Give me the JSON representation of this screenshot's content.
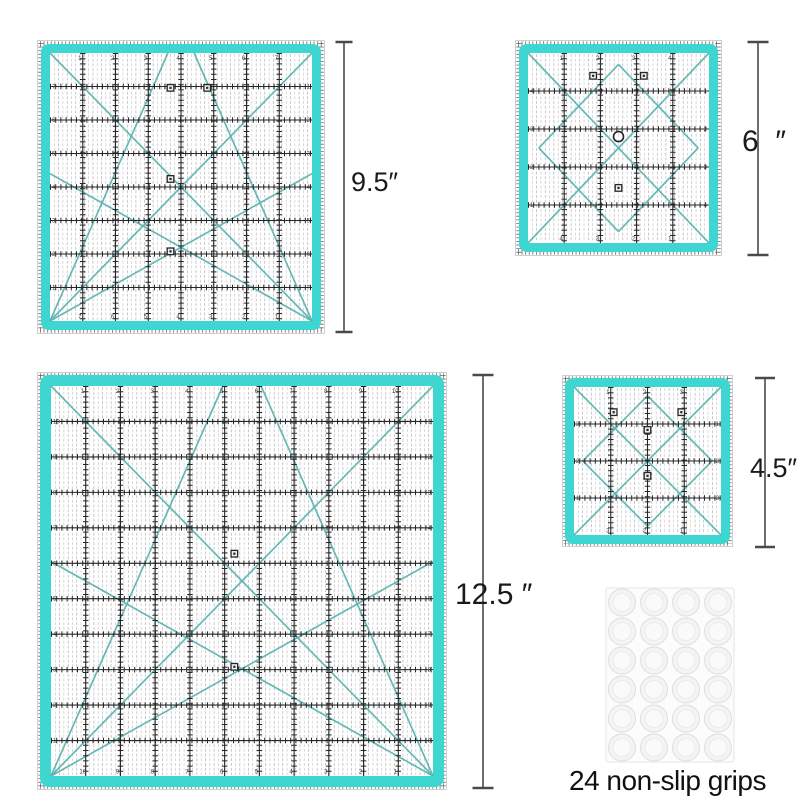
{
  "canvas": {
    "width": 800,
    "height": 800,
    "background": "#ffffff"
  },
  "colors": {
    "teal_band": "#3ed6d0",
    "teal_diagonal": "#58b4b1",
    "grid_black": "#262626",
    "pinstripe_light": "#c6c6c6",
    "pinstripe_dark": "#adadad",
    "dimension_line": "#4a4a4a",
    "label_text": "#1a1a1a"
  },
  "rulers": [
    {
      "name": "ruler-9.5-inch",
      "size_inches": "9.5",
      "x": 37,
      "y": 40,
      "w": 288,
      "h": 294,
      "cells": 8,
      "band": 9,
      "inset": 13,
      "diagonals": [
        [
          0,
          1,
          1,
          0
        ],
        [
          0,
          0,
          1,
          1
        ],
        [
          0,
          1,
          0.45,
          0
        ],
        [
          1,
          1,
          0.55,
          0
        ],
        [
          0,
          1,
          1,
          0.45
        ],
        [
          0,
          0.45,
          1,
          1
        ]
      ],
      "markers": [
        [
          0.46,
          0.13
        ],
        [
          0.6,
          0.13
        ],
        [
          0.46,
          0.47
        ],
        [
          0.46,
          0.74
        ]
      ],
      "rings": []
    },
    {
      "name": "ruler-6-inch",
      "size_inches": "6",
      "x": 515,
      "y": 40,
      "w": 207,
      "h": 216,
      "cells": 5,
      "band": 9,
      "inset": 13,
      "diagonals": [
        [
          0,
          0,
          1,
          1
        ],
        [
          0,
          1,
          1,
          0
        ],
        [
          0.5,
          0.06,
          0.94,
          0.5
        ],
        [
          0.94,
          0.5,
          0.5,
          0.94
        ],
        [
          0.5,
          0.94,
          0.06,
          0.5
        ],
        [
          0.06,
          0.5,
          0.5,
          0.06
        ]
      ],
      "markers": [
        [
          0.36,
          0.12
        ],
        [
          0.64,
          0.12
        ],
        [
          0.5,
          0.71
        ]
      ],
      "rings": [
        [
          0.5,
          0.44
        ]
      ]
    },
    {
      "name": "ruler-12.5-inch",
      "size_inches": "12.5",
      "x": 37,
      "y": 372,
      "w": 410,
      "h": 418,
      "cells": 11,
      "band": 11,
      "inset": 14,
      "diagonals": [
        [
          0,
          1,
          1,
          0
        ],
        [
          0,
          0,
          1,
          1
        ],
        [
          0,
          1,
          0.45,
          0
        ],
        [
          1,
          1,
          0.55,
          0
        ],
        [
          0,
          1,
          1,
          0.45
        ],
        [
          0,
          0.45,
          1,
          1
        ]
      ],
      "markers": [
        [
          0.48,
          0.43
        ],
        [
          0.48,
          0.72
        ]
      ],
      "rings": []
    },
    {
      "name": "ruler-4.5-inch",
      "size_inches": "4.5",
      "x": 562,
      "y": 375,
      "w": 171,
      "h": 172,
      "cells": 4,
      "band": 9,
      "inset": 12,
      "diagonals": [
        [
          0,
          0,
          1,
          1
        ],
        [
          0,
          1,
          1,
          0
        ],
        [
          0.5,
          0.06,
          0.94,
          0.5
        ],
        [
          0.94,
          0.5,
          0.5,
          0.94
        ],
        [
          0.5,
          0.94,
          0.06,
          0.5
        ],
        [
          0.06,
          0.5,
          0.5,
          0.06
        ]
      ],
      "markers": [
        [
          0.27,
          0.17
        ],
        [
          0.5,
          0.29
        ],
        [
          0.73,
          0.17
        ],
        [
          0.5,
          0.6
        ]
      ],
      "rings": []
    }
  ],
  "dimension_lines": [
    {
      "x": 344,
      "y1": 41,
      "y2": 333,
      "cap": 17
    },
    {
      "x": 758,
      "y1": 41,
      "y2": 256,
      "cap": 21
    },
    {
      "x": 483,
      "y1": 374,
      "y2": 789,
      "cap": 21
    },
    {
      "x": 765,
      "y1": 377,
      "y2": 548,
      "cap": 20
    }
  ],
  "dimension_labels": [
    {
      "text": "9.5″",
      "left": 351,
      "top": 169,
      "size": 27
    },
    {
      "text": "6  ″",
      "left": 742,
      "top": 127,
      "size": 30
    },
    {
      "text": "12.5 ″",
      "left": 455,
      "top": 580,
      "size": 30
    },
    {
      "text": "4.5″",
      "left": 750,
      "top": 455,
      "size": 27
    }
  ],
  "grips": {
    "x": 606,
    "y": 588,
    "w": 128,
    "h": 174,
    "rows": 6,
    "cols": 4,
    "r": 13.5,
    "caption": "24 non-slip grips",
    "caption_left": 569,
    "caption_top": 766,
    "caption_size": 28
  }
}
